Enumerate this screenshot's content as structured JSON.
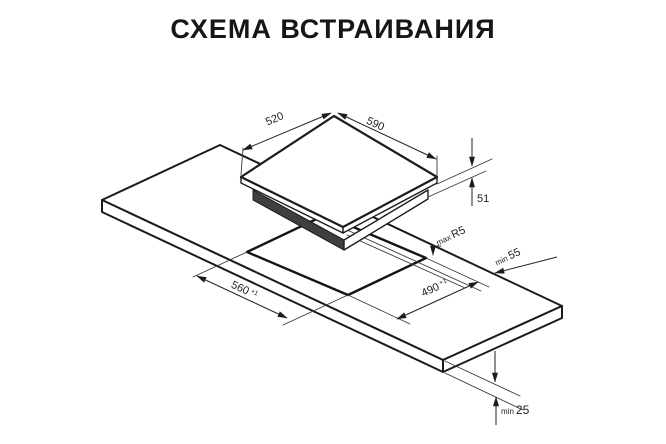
{
  "title": "СХЕМА ВСТРАИВАНИЯ",
  "dimensions": {
    "hob_width": {
      "value": "520"
    },
    "hob_depth": {
      "value": "590"
    },
    "hob_height": {
      "value": "51"
    },
    "cutout_width": {
      "value": "560",
      "tolerance": "+1"
    },
    "cutout_depth": {
      "value": "490",
      "tolerance": "+1"
    },
    "cutout_corner_radius": {
      "prefix": "max",
      "value": "R5"
    },
    "rear_clearance": {
      "prefix": "min",
      "value": "55"
    },
    "worktop_thickness": {
      "prefix": "min",
      "value": "25"
    }
  }
}
